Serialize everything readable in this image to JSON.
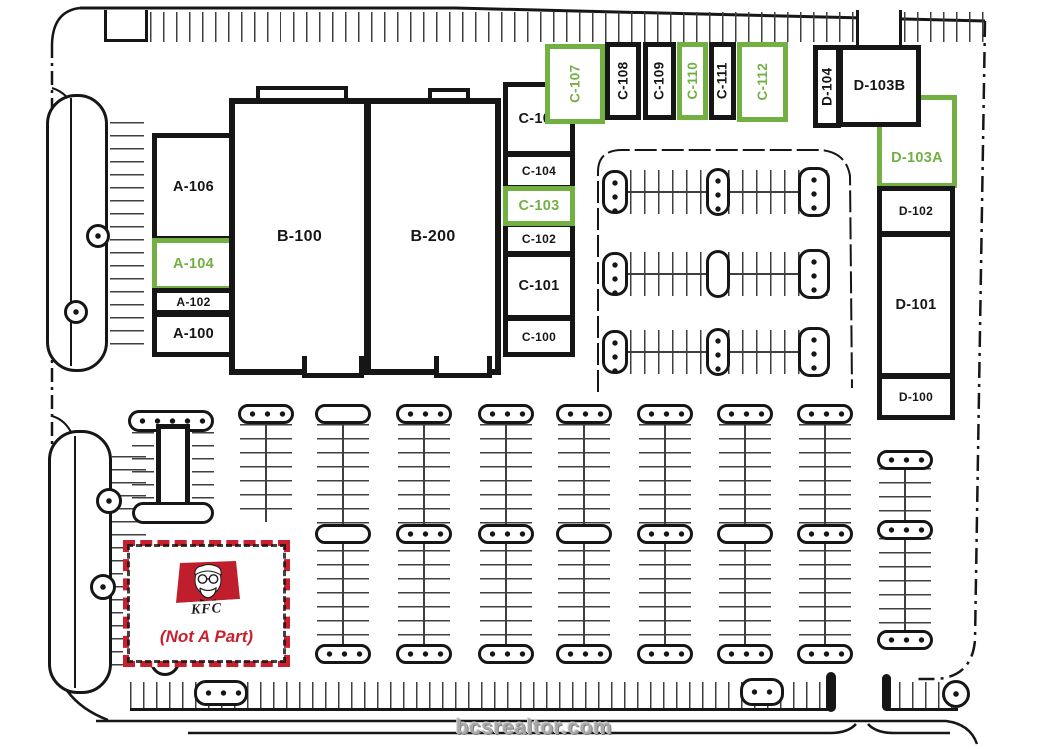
{
  "site": {
    "watermark": "bcsrealtor.com"
  },
  "colors": {
    "highlight": "#72b044",
    "ink": "#161616",
    "kfc_red": "#c8202f",
    "tick": "#3f3f3f",
    "watermark_gray": "#a9a9a9"
  },
  "kfc": {
    "brand": "KFC",
    "note": "(Not A Part)"
  },
  "units": {
    "a100": {
      "label": "A-100",
      "highlighted": false
    },
    "a102": {
      "label": "A-102",
      "highlighted": false
    },
    "a104": {
      "label": "A-104",
      "highlighted": true
    },
    "a106": {
      "label": "A-106",
      "highlighted": false
    },
    "b100": {
      "label": "B-100",
      "highlighted": false
    },
    "b200": {
      "label": "B-200",
      "highlighted": false
    },
    "c100": {
      "label": "C-100",
      "highlighted": false
    },
    "c101": {
      "label": "C-101",
      "highlighted": false
    },
    "c102": {
      "label": "C-102",
      "highlighted": false
    },
    "c103": {
      "label": "C-103",
      "highlighted": true
    },
    "c104": {
      "label": "C-104",
      "highlighted": false
    },
    "c105": {
      "label": "C-105",
      "highlighted": false
    },
    "c107": {
      "label": "C-107",
      "highlighted": true
    },
    "c108": {
      "label": "C-108",
      "highlighted": false
    },
    "c109": {
      "label": "C-109",
      "highlighted": false
    },
    "c110": {
      "label": "C-110",
      "highlighted": true
    },
    "c111": {
      "label": "C-111",
      "highlighted": false
    },
    "c112": {
      "label": "C-112",
      "highlighted": true
    },
    "d100": {
      "label": "D-100",
      "highlighted": false
    },
    "d101": {
      "label": "D-101",
      "highlighted": false
    },
    "d102": {
      "label": "D-102",
      "highlighted": false
    },
    "d103a": {
      "label": "D-103A",
      "highlighted": true
    },
    "d103b": {
      "label": "D-103B",
      "highlighted": false
    },
    "d104": {
      "label": "D-104",
      "highlighted": false
    }
  }
}
